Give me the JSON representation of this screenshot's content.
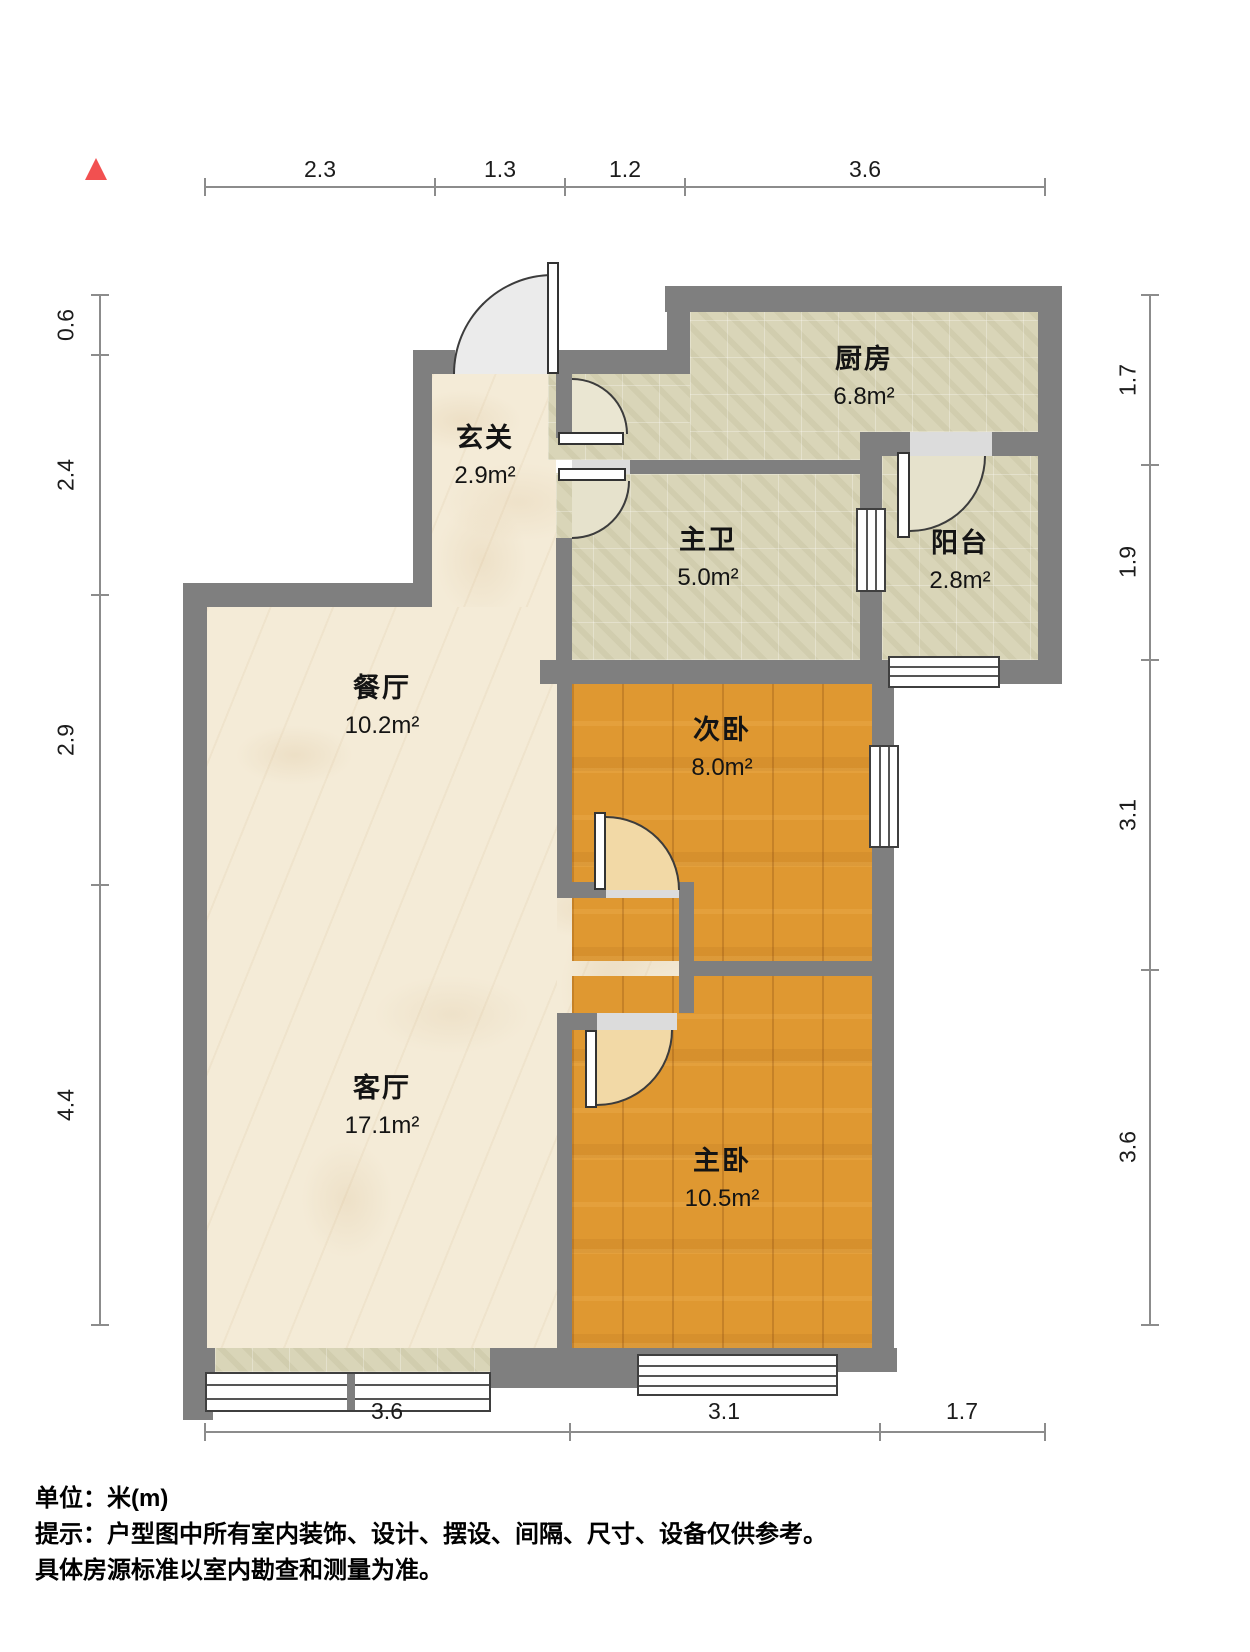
{
  "dims": {
    "top": [
      "2.3",
      "1.3",
      "1.2",
      "3.6"
    ],
    "left": [
      "0.6",
      "2.4",
      "2.9",
      "4.4"
    ],
    "right": [
      "1.7",
      "1.9",
      "3.1",
      "3.6"
    ],
    "bottom": [
      "3.6",
      "3.1",
      "1.7"
    ]
  },
  "rooms": {
    "kitchen": {
      "name": "厨房",
      "area": "6.8m²"
    },
    "entry": {
      "name": "玄关",
      "area": "2.9m²"
    },
    "bath": {
      "name": "主卫",
      "area": "5.0m²"
    },
    "balcony": {
      "name": "阳台",
      "area": "2.8m²"
    },
    "dining": {
      "name": "餐厅",
      "area": "10.2m²"
    },
    "bedroom2": {
      "name": "次卧",
      "area": "8.0m²"
    },
    "living": {
      "name": "客厅",
      "area": "17.1m²"
    },
    "bedroom1": {
      "name": "主卧",
      "area": "10.5m²"
    }
  },
  "footer": {
    "unit": "单位：米(m)",
    "tip": "提示：户型图中所有室内装饰、设计、摆设、间隔、尺寸、设备仅供参考。",
    "tip2": "具体房源标准以室内勘查和测量为准。"
  },
  "colors": {
    "wall": "#7f7f7f",
    "north_marker": "#f25050",
    "floor_marble": "#f4ebd7",
    "floor_tile": "#d9d5b8",
    "floor_wood": "#df9831"
  }
}
